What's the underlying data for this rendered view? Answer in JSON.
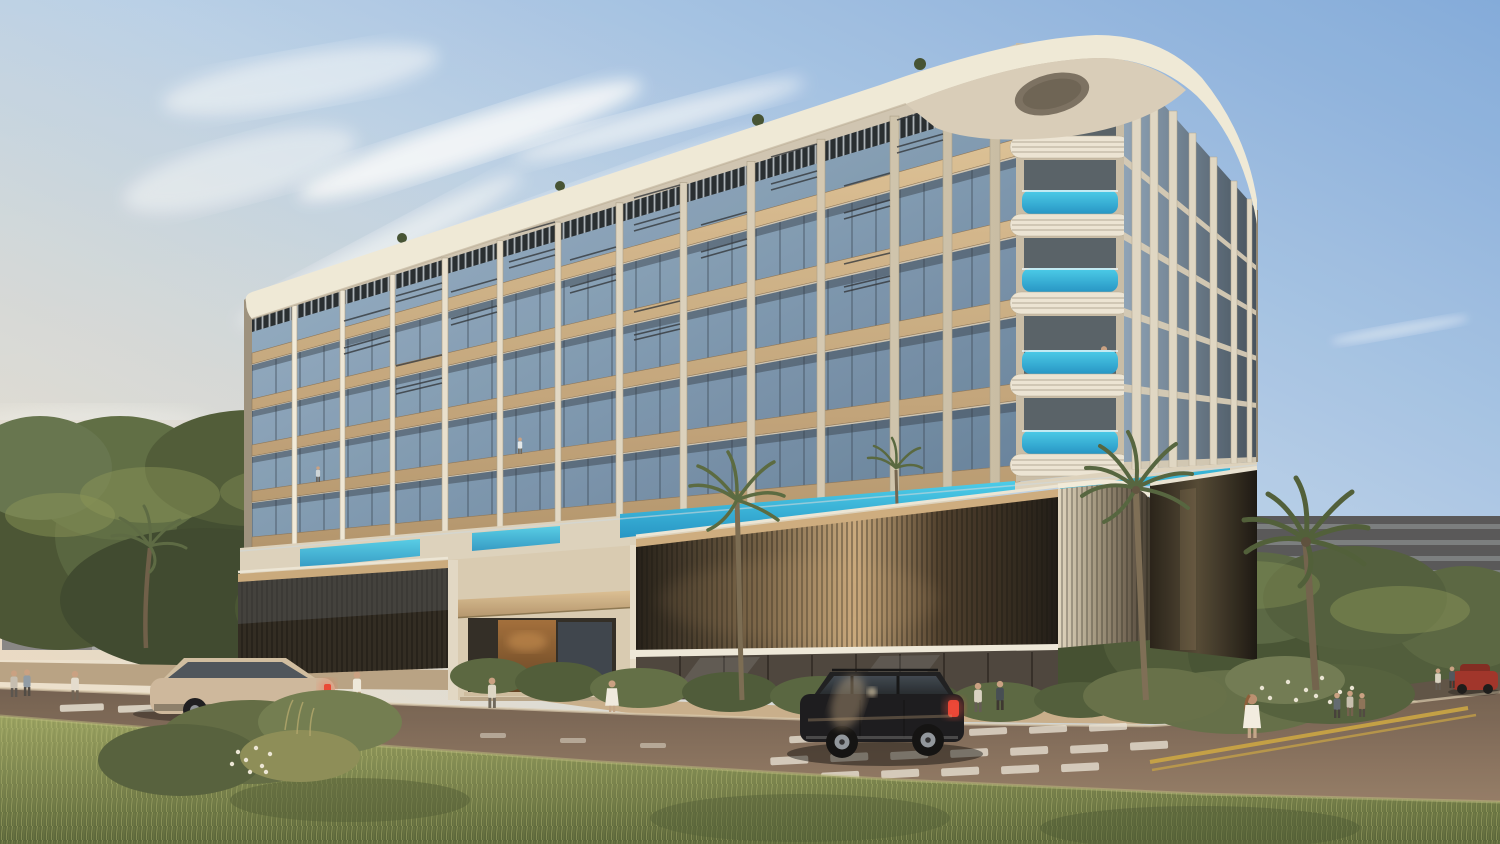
{
  "scene": {
    "subject": "luxury-residential-building-exterior",
    "view": "street-corner-perspective"
  },
  "palette": {
    "sky_top": "#7fa9dc",
    "sky_mid": "#b7d0ea",
    "sky_horizon": "#efe3d0",
    "cloud_white": "#ffffff",
    "roof_white": "#f0ead9",
    "fin_cream": "#ebe3d1",
    "facade_glass_light": "#9db7cd",
    "facade_glass_dark": "#5f7b97",
    "wood_light": "#dcc094",
    "wood_dark": "#b2936a",
    "pool_light": "#45cdec",
    "pool_deep": "#1e93c6",
    "bronze_sheen": "#c9a87b",
    "bronze_dark": "#191510",
    "sidewalk": "#c8ad89",
    "road_light": "#937a64",
    "road_dark": "#6e5b4c",
    "grass_light": "#97a05e",
    "grass_dark": "#525f33",
    "tree_green": "#46532f",
    "palm_green": "#4e5c36",
    "bg_left_gray": "#868b92",
    "bg_right_beige": "#afa28d",
    "curb_yellow": "#caa43e",
    "marking_white": "#e7e1d3"
  },
  "building": {
    "residential_floors_visible": 5,
    "podium_levels": 2,
    "rooftop_pergola": true,
    "balcony_pools": true,
    "corner_style": "rounded-banded"
  },
  "vehicles": {
    "suv_color": "#141418",
    "hatchback_color": "#cdb79b",
    "parked_car_color": "#9e2e24",
    "taillight_color": "#e23a2a"
  }
}
